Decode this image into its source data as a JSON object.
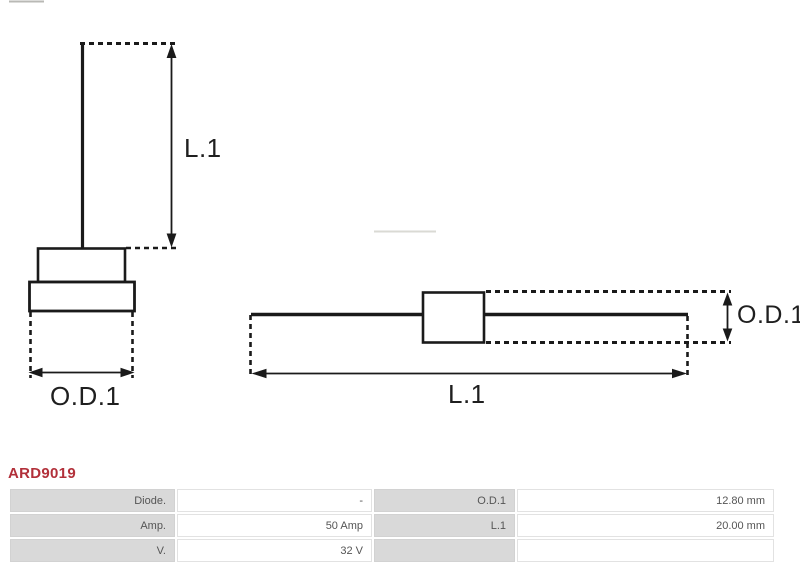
{
  "product": {
    "code": "ARD9019",
    "code_color": "#b2303a"
  },
  "diagram": {
    "type": "technical-drawing-diode",
    "line_color": "#1a1a1a",
    "labels": {
      "front_view_length": "L.1",
      "front_view_outer_diameter": "O.D.1",
      "side_view_outer_diameter": "O.D.1",
      "side_view_length": "L.1"
    }
  },
  "spec_table": {
    "rows": [
      {
        "label1": "Diode.",
        "value1": "-",
        "label2": "O.D.1",
        "value2": "12.80 mm"
      },
      {
        "label1": "Amp.",
        "value1": "50 Amp",
        "label2": "L.1",
        "value2": "20.00 mm"
      },
      {
        "label1": "V.",
        "value1": "32 V",
        "label2": "",
        "value2": ""
      }
    ]
  }
}
